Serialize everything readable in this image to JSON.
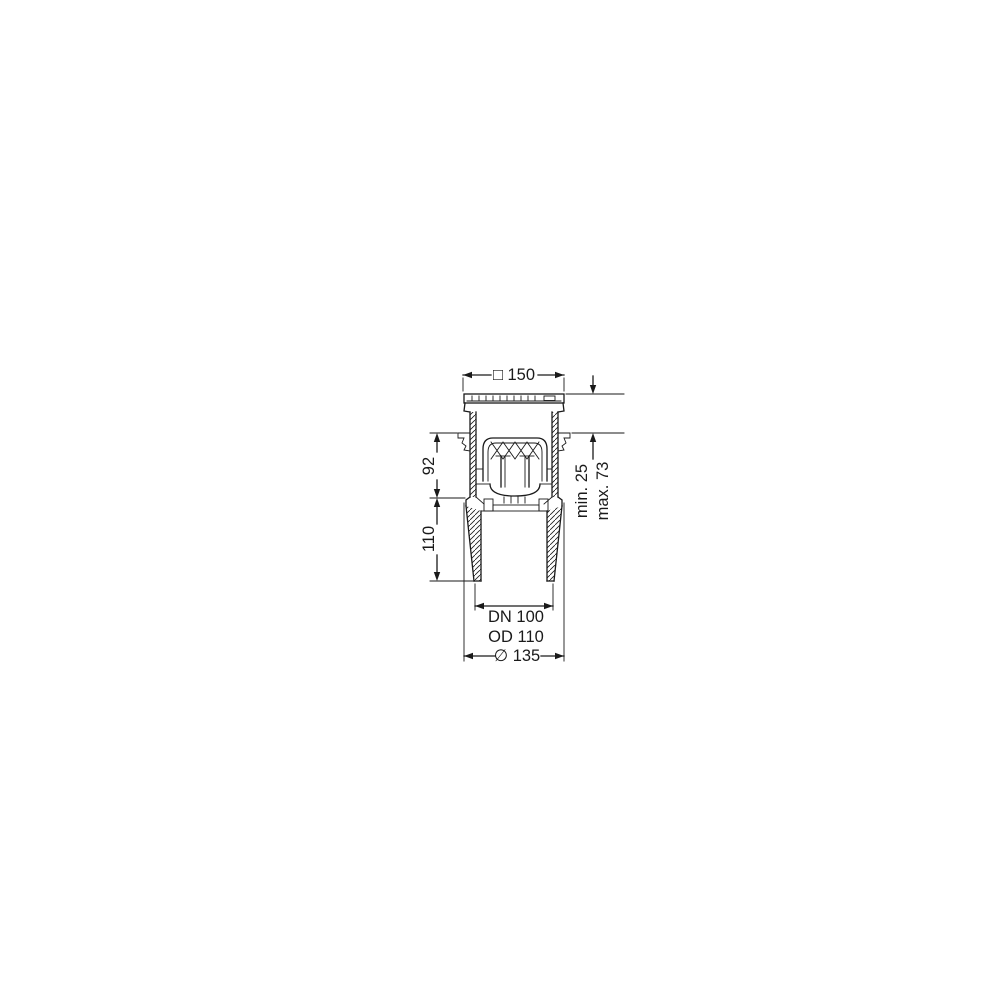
{
  "page": {
    "background_color": "#ffffff"
  },
  "drawing": {
    "kind": "technical-cross-section",
    "subject": "floor-drain-with-odour-trap-and-vertical-outlet",
    "line_color": "#1a1a1a",
    "labels": {
      "top_width": "□ 150",
      "upper_height": "92",
      "lower_height": "110",
      "install_min": "min. 25",
      "install_max": "max. 73",
      "outlet_nominal": "DN 100",
      "outlet_outer": "OD 110",
      "body_diameter": "∅ 135"
    }
  }
}
